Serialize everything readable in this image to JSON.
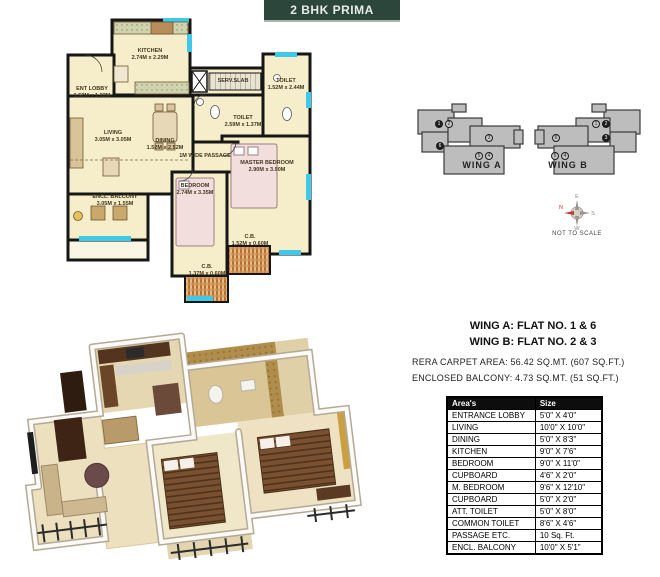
{
  "banner": {
    "title": "2 BHK PRIMA"
  },
  "colors": {
    "banner_bg": "#2c463c",
    "banner_text": "#e7ebe8",
    "wall": "#161616",
    "floor": "#f6eecb",
    "window_cyan": "#3ec9e9",
    "building_gray": "#bdbdbd",
    "cupboard_hatch": "#c4782f",
    "table_header_bg": "#0d0d0d"
  },
  "plan2d": {
    "rooms": {
      "kitchen": {
        "name": "KITCHEN",
        "size": "2.74M x 2.29M"
      },
      "ent_lobby": {
        "name": "ENT LOBBY",
        "size": "1.52M x 1.22M"
      },
      "living": {
        "name": "LIVING",
        "size": "3.05M x 3.05M"
      },
      "dining": {
        "name": "DINING",
        "size": "1.52M x 2.52M"
      },
      "toilet_common": {
        "name": "TOILET",
        "size": "2.59M x 1.37M"
      },
      "toilet_att": {
        "name": "TOILET",
        "size": "1.52M x 2.44M"
      },
      "master_bedroom": {
        "name": "MASTER BEDROOM",
        "size": "2.90M x 3.90M"
      },
      "bedroom": {
        "name": "BEDROOM",
        "size": "2.74M x 3.35M"
      },
      "encl_balcony": {
        "name": "ENCL. BALCONY",
        "size": "3.05M x 1.55M"
      },
      "cb_small": {
        "name": "C.B.",
        "size": "1.37M x 0.60M"
      },
      "cb_large": {
        "name": "C.B.",
        "size": "1.52M x 0.60M"
      }
    },
    "passage_label": "1M WIDE PASSAGE",
    "serv_slab_label": "SERV.SLAB"
  },
  "wing_diagram": {
    "wing_a": {
      "label": "WING A",
      "flats": [
        {
          "n": "1",
          "filled": true
        },
        {
          "n": "2",
          "filled": false
        },
        {
          "n": "3",
          "filled": false
        },
        {
          "n": "4",
          "filled": false
        },
        {
          "n": "5",
          "filled": false
        },
        {
          "n": "6",
          "filled": true
        }
      ]
    },
    "wing_b": {
      "label": "WING B",
      "flats": [
        {
          "n": "1",
          "filled": false
        },
        {
          "n": "2",
          "filled": true
        },
        {
          "n": "3",
          "filled": true
        },
        {
          "n": "4",
          "filled": false
        },
        {
          "n": "5",
          "filled": false
        },
        {
          "n": "6",
          "filled": false
        }
      ]
    },
    "compass": {
      "e": "E",
      "n": "N",
      "s": "S",
      "w": "W"
    },
    "not_to_scale": "NOT TO SCALE"
  },
  "info": {
    "wing_a_line": "WING A: FLAT NO. 1 & 6",
    "wing_b_line": "WING B: FLAT NO. 2 & 3",
    "rera_line": "RERA CARPET AREA: 56.42 SQ.MT. (607 SQ.FT.)",
    "balcony_line": "ENCLOSED BALCONY: 4.73 SQ.MT. (51 SQ.FT.)"
  },
  "area_table": {
    "headers": [
      "Area's",
      "Size"
    ],
    "rows": [
      [
        "ENTRANCE LOBBY",
        "5'0\" X 4'0\""
      ],
      [
        "LIVING",
        "10'0\" X 10'0\""
      ],
      [
        "DINING",
        "5'0\" X 8'3\""
      ],
      [
        "KITCHEN",
        "9'0\" X 7'6\""
      ],
      [
        "BEDROOM",
        "9'0\" X 11'0\""
      ],
      [
        "CUPBOARD",
        "4'6\" X 2'0\""
      ],
      [
        "M. BEDROOM",
        "9'6\" X 12'10\""
      ],
      [
        "CUPBOARD",
        "5'0\" X 2'0\""
      ],
      [
        "ATT. TOILET",
        "5'0\" X 8'0\""
      ],
      [
        "COMMON  TOILET",
        "8'6\" X 4'6\""
      ],
      [
        "PASSAGE ETC.",
        "10 Sq. Ft."
      ],
      [
        "ENCL. BALCONY",
        "10'0\" X 5'1\""
      ]
    ]
  }
}
